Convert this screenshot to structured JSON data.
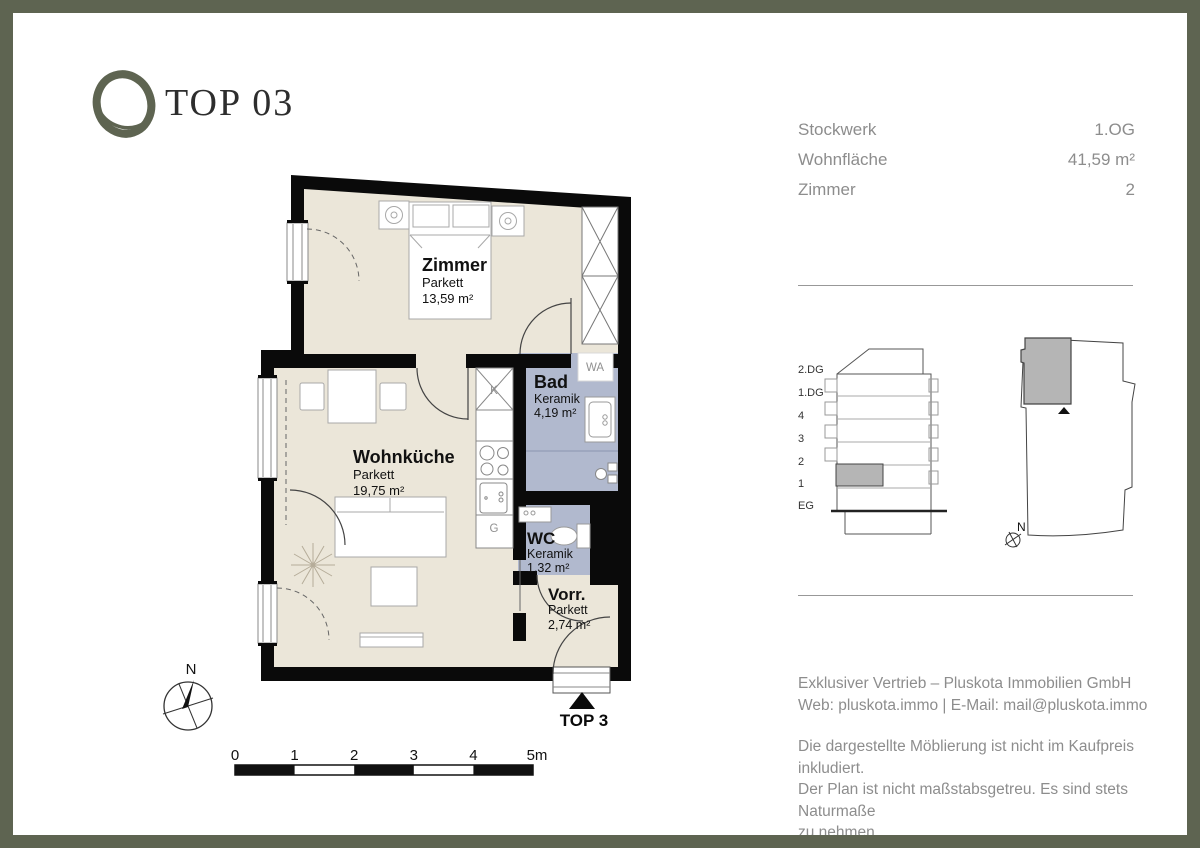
{
  "header": {
    "title": "TOP 03"
  },
  "unit_info": {
    "rows": [
      {
        "label": "Stockwerk",
        "value": "1.OG"
      },
      {
        "label": "Wohnfläche",
        "value": "41,59 m²"
      },
      {
        "label": "Zimmer",
        "value": "2"
      }
    ]
  },
  "floorplan": {
    "rooms": [
      {
        "name": "Zimmer",
        "floor": "Parkett",
        "area": "13,59 m²"
      },
      {
        "name": "Wohnküche",
        "floor": "Parkett",
        "area": "19,75 m²"
      },
      {
        "name": "Bad",
        "floor": "Keramik",
        "area": "4,19 m²"
      },
      {
        "name": "WC",
        "floor": "Keramik",
        "area": "1,32 m²"
      },
      {
        "name": "Vorr.",
        "floor": "Parkett",
        "area": "2,74 m²"
      }
    ],
    "fixtures": {
      "washing_machine": "WA",
      "fridge": "K",
      "dishwasher": "G"
    },
    "entrance_label": "TOP 3",
    "compass_label": "N",
    "scale_ticks": [
      "0",
      "1",
      "2",
      "3",
      "4",
      "5m"
    ]
  },
  "building_section": {
    "floor_labels": [
      "2.DG",
      "1.DG",
      "4",
      "3",
      "2",
      "1",
      "EG"
    ]
  },
  "site_plan": {
    "compass_label": "N"
  },
  "footer": {
    "vendor_line1": "Exklusiver Vertrieb – Pluskota Immobilien GmbH",
    "vendor_line2": "Web: pluskota.immo | E-Mail: mail@pluskota.immo",
    "legal_line1": "Die dargestellte Möblierung ist nicht im Kaufpreis inkludiert.",
    "legal_line2": "Der Plan ist nicht maßstabsgetreu. Es sind stets Naturmaße",
    "legal_line3": "zu nehmen."
  },
  "colors": {
    "frame": "#5e6451",
    "wall": "#0a0a0a",
    "floor_dry": "#ebe6d9",
    "floor_wet": "#b1b9ce",
    "marker_gray": "#b5b5b5",
    "text_gray": "#8d8d8d"
  }
}
